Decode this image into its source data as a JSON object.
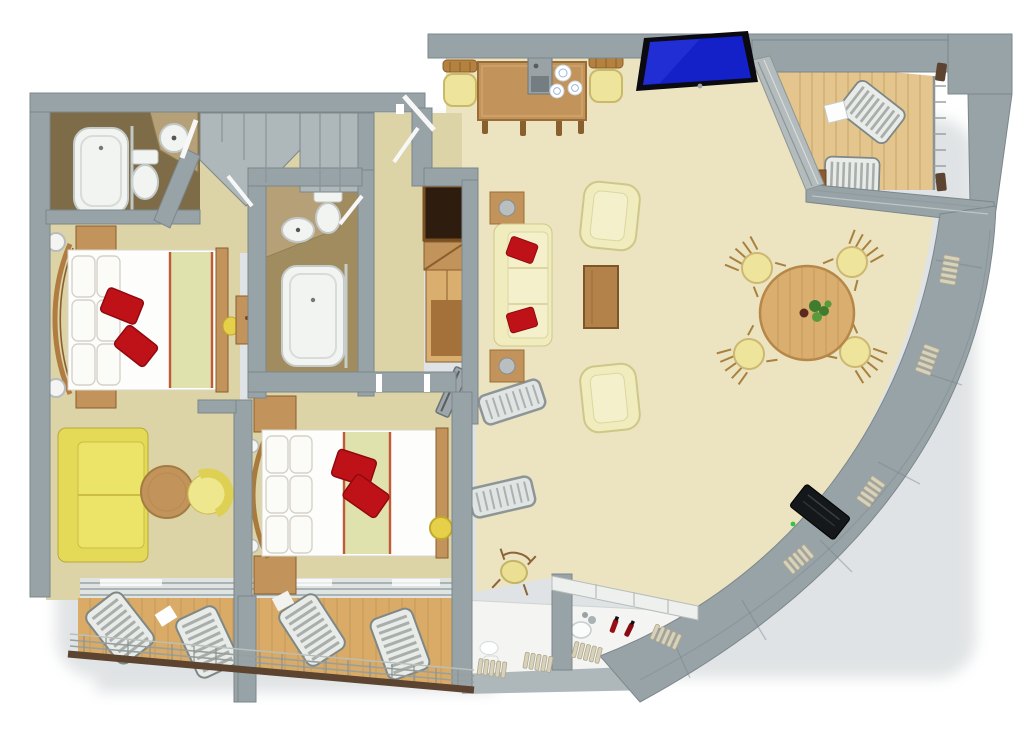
{
  "title": "3d-floor-plan-render",
  "colors": {
    "wall": "#98a3a8",
    "wallFace": "#aeb7ba",
    "wallDark": "#74808a",
    "wallEdge": "#cdd4d6",
    "carpet": "#ece3c0",
    "carpetOlive": "#dcd3a6",
    "bathFloor1": "#7d6c47",
    "bathFloor2": "#a08c5e",
    "stone": "#b5a078",
    "deck": "#d9ab67",
    "deckLight": "#e3c58d",
    "deckLine": "#b98f55",
    "wood": "#c2935a",
    "woodLight": "#d9ae6f",
    "woodDark": "#8a5f2e",
    "sofaYellow": "#e4da57",
    "paleYellow": "#efe49b",
    "cream": "#f0ecbe",
    "creamDark": "#e6e0a0",
    "porcelain": "#f2f4f2",
    "bedWhite": "#fdfdfb",
    "runnerGreen": "#dfe2ac",
    "runnerTrim": "#c05a3a",
    "accentRed": "#bf1218",
    "accentRedDark": "#90090f",
    "tvBlue": "#1420c8",
    "tvBlack": "#15181a",
    "metal": "#9aa4a6",
    "metalLight": "#c8cdcd",
    "glass": "#dfe4e3",
    "railBrown": "#5c4430",
    "plantGreen": "#3f7c2e",
    "poufYellow": "#e6d049",
    "ribTan": "#d8d2ba"
  },
  "areas": {
    "master_bathroom": {
      "items": [
        "bathtub",
        "glass-screen",
        "toilet",
        "corner-washbasin",
        "stone-counter",
        "door"
      ]
    },
    "entry_hall": {
      "items": [
        "corner-closet",
        "wardrobe-closet",
        "entry-door"
      ]
    },
    "guest_bathroom": {
      "items": [
        "stone-counter",
        "washbasin",
        "toilet",
        "bathtub",
        "door"
      ]
    },
    "hall_wardrobe": {
      "items": [
        "open-shelf-unit",
        "cabinet",
        "tv-panel",
        "luggage-rack"
      ]
    },
    "master_bedroom": {
      "items": [
        "double-bed",
        "curved-headboard",
        "nightstand",
        "nightstand",
        "wall-lamp",
        "wall-lamp",
        "red-accent-pillows",
        "green-runner",
        "writing-desk",
        "stool"
      ]
    },
    "master_lounge": {
      "items": [
        "yellow-sofa",
        "round-side-table",
        "tub-chair"
      ]
    },
    "bedroom_two": {
      "items": [
        "double-bed",
        "curved-headboard",
        "nightstand",
        "nightstand",
        "red-accent-pillows",
        "green-runner",
        "pouf"
      ]
    },
    "living_room": {
      "items": [
        "cream-sofa",
        "end-table-lamp",
        "end-table-lamp",
        "armchair",
        "armchair",
        "coffee-table",
        "luggage-rack"
      ]
    },
    "dining_area": {
      "items": [
        "round-dining-table",
        "plant-centerpiece",
        "dining-chair",
        "dining-chair",
        "dining-chair",
        "dining-chair"
      ]
    },
    "kitchen_buffet": {
      "items": [
        "buffet-table",
        "coffee-machine",
        "plates",
        "side-chair",
        "side-chair",
        "wall-tv-blue"
      ]
    },
    "veranda": {
      "items": [
        "wood-deck",
        "sun-lounger",
        "sun-lounger",
        "small-table",
        "railing",
        "glazed-sliding-doors"
      ]
    },
    "balcony": {
      "items": [
        "wood-deck",
        "sun-lounger",
        "sun-lounger",
        "sun-lounger",
        "sun-lounger",
        "sliding-glass-doors",
        "railing",
        "divider-wall"
      ]
    },
    "dressing_corner": {
      "items": [
        "vanity-counter",
        "washbasin",
        "perfume-bottles",
        "chair",
        "low-panel-wall"
      ]
    },
    "curved_facade": {
      "items": [
        "paneled-wall",
        "radiator-ribs",
        "wall-tv-black"
      ]
    }
  }
}
